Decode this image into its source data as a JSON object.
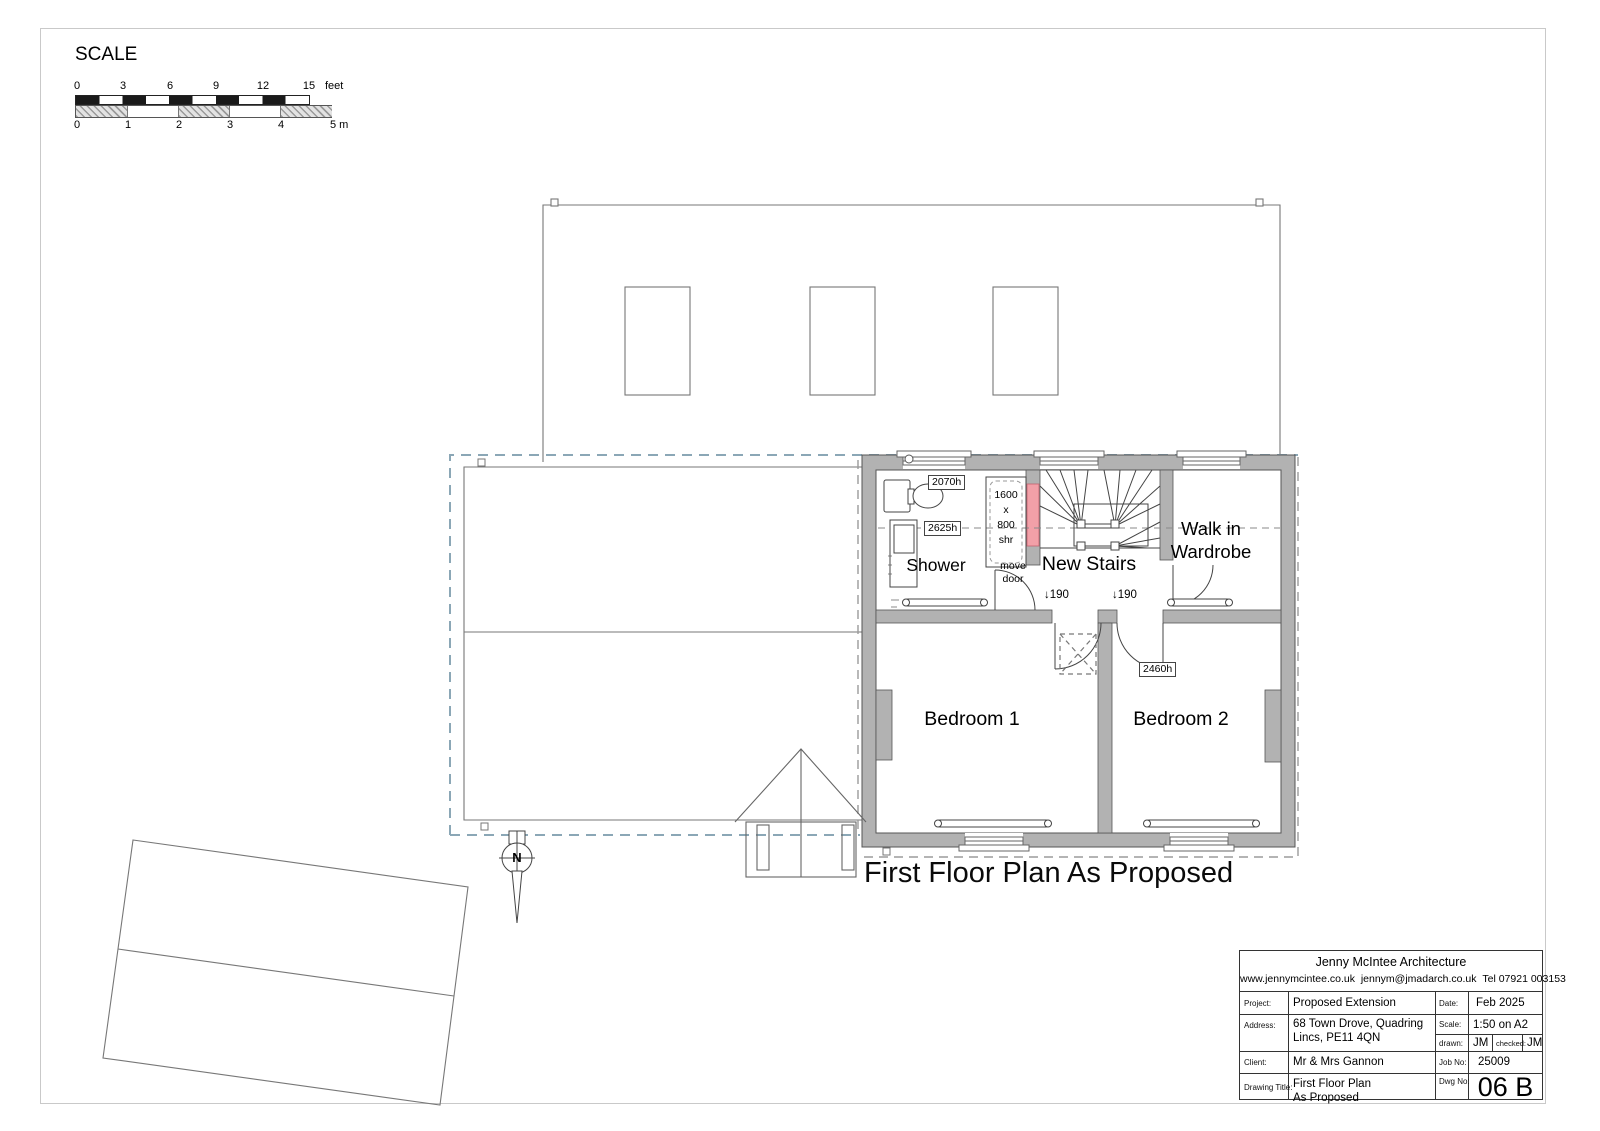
{
  "colors": {
    "wall_fill": "#b2b2b2",
    "highlight_wall": "#f2a0a8",
    "dashed_outline_blue": "#8ba7b6",
    "dashed_outline_gray": "#9b9b9b",
    "linework": "#555555"
  },
  "scale_bar": {
    "title": "SCALE",
    "feet_ticks": {
      "t0": "0",
      "t1": "3",
      "t2": "6",
      "t3": "9",
      "t4": "12",
      "t5": "15"
    },
    "feet_unit": "feet",
    "meter_ticks": {
      "t0": "0",
      "t1": "1",
      "t2": "2",
      "t3": "3",
      "t4": "4"
    },
    "meter_end": "5 m"
  },
  "plan": {
    "rooms": {
      "shower": "Shower",
      "stairs": "New Stairs",
      "wardrobe_l1": "Walk in",
      "wardrobe_l2": "Wardrobe",
      "bedroom1": "Bedroom 1",
      "bedroom2": "Bedroom 2"
    },
    "annotations": {
      "ceiling_2070": "2070h",
      "ceiling_2625": "2625h",
      "ceiling_2460": "2460h",
      "shower_size_l1": "1600",
      "shower_size_l2": "x",
      "shower_size_l3": "800",
      "shower_size_l4": "shr",
      "move_door_l1": "move",
      "move_door_l2": "door",
      "step_left": "↓190",
      "step_right": "↓190"
    },
    "north_letter": "N",
    "caption": "First Floor Plan As Proposed"
  },
  "title_block": {
    "company": "Jenny McIntee Architecture",
    "website": "www.jennymcintee.co.uk",
    "email": "jennym@jmadarch.co.uk",
    "phone": "Tel 07921 003153",
    "project_label": "Project:",
    "project": "Proposed Extension",
    "date_label": "Date:",
    "date": "Feb 2025",
    "address_label": "Address:",
    "address_l1": "68 Town Drove, Quadring",
    "address_l2": "Lincs, PE11 4QN",
    "scale_label": "Scale:",
    "scale": "1:50 on A2",
    "drawn_label": "drawn:",
    "drawn": "JM",
    "checked_label": "checked:",
    "checked": "JM",
    "client_label": "Client:",
    "client": "Mr & Mrs Gannon",
    "job_label": "Job No:",
    "job": "25009",
    "dwg_title_label": "Drawing Title:",
    "dwg_title_l1": "First Floor Plan",
    "dwg_title_l2": "As Proposed",
    "dwg_no_label": "Dwg No:",
    "dwg_no": "06 B"
  }
}
